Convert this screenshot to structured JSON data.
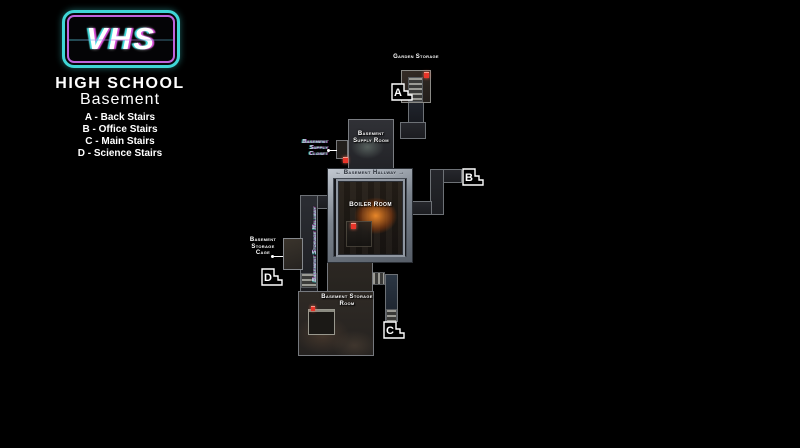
{
  "panel": {
    "logo_text": "VHS",
    "title": "HIGH SCHOOL",
    "subtitle": "Basement",
    "legend": [
      "A - Back Stairs",
      "B - Office Stairs",
      "C - Main Stairs",
      "D - Science Stairs"
    ]
  },
  "map": {
    "labels": {
      "garden_storage": "Garden Storage",
      "supply_room": "Basement Supply Room",
      "supply_closet": "Basement Supply Closet",
      "hallway": "← Basement Hallway →",
      "boiler_room": "Boiler Room",
      "storage_hallway": "Basement Storage Hallway",
      "storage_cage": "Basement Storage Cage",
      "storage_room": "Basement Storage Room"
    },
    "stairs": {
      "a": "A",
      "b": "B",
      "c": "C",
      "d": "D"
    }
  },
  "colors": {
    "background": "#000000",
    "marker_red": "#e8352a",
    "fire_glow": "#f28c2a",
    "frame_silver": "#9aa2ac",
    "glitch_teal": "#b9e7e0",
    "glitch_magenta": "#d85ad8",
    "logo_teal": "#3fd6d6",
    "logo_purple": "#bf63dc"
  }
}
